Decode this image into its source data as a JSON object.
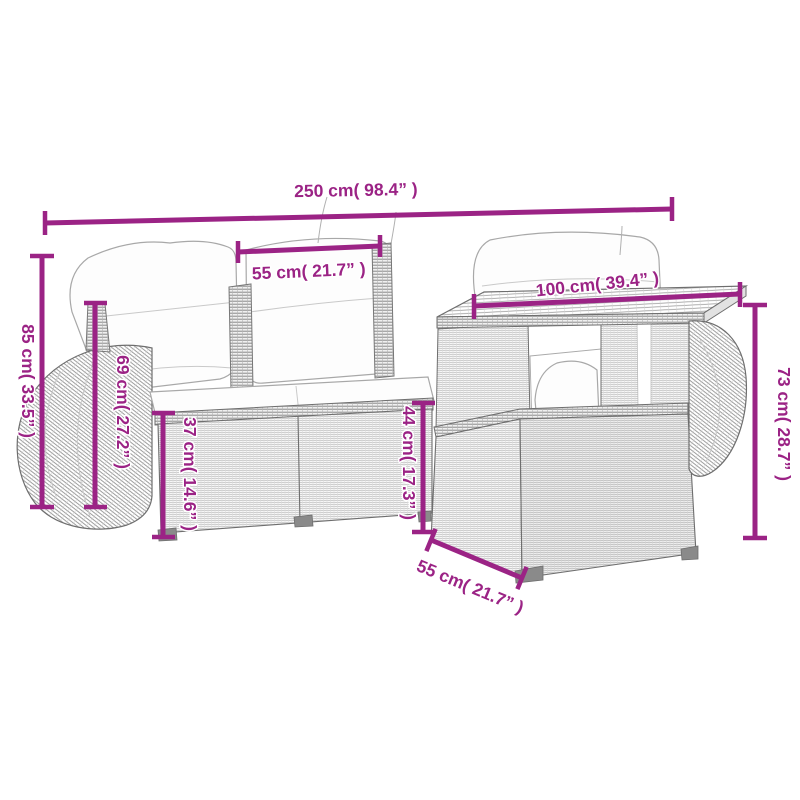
{
  "page": {
    "background": "#ffffff"
  },
  "diagram": {
    "type": "product-dimension-diagram",
    "subject": "rattan garden sofa set with table and armrest modules",
    "accent_color": "#9B2385",
    "drawing_line_color": "#6e6e6e"
  },
  "dimensions": {
    "total_width": "250 cm( 98.4” )",
    "seat_width": "55 cm( 21.7” )",
    "table_top_width": "100 cm( 39.4” )",
    "total_height": "85 cm( 33.5” )",
    "backrest_height": "69 cm( 27.2” )",
    "seat_height": "37 cm( 14.6” )",
    "table_seat_height": "44 cm( 17.3” )",
    "table_height": "73 cm( 28.7” )",
    "table_depth": "55 cm( 21.7” )"
  }
}
